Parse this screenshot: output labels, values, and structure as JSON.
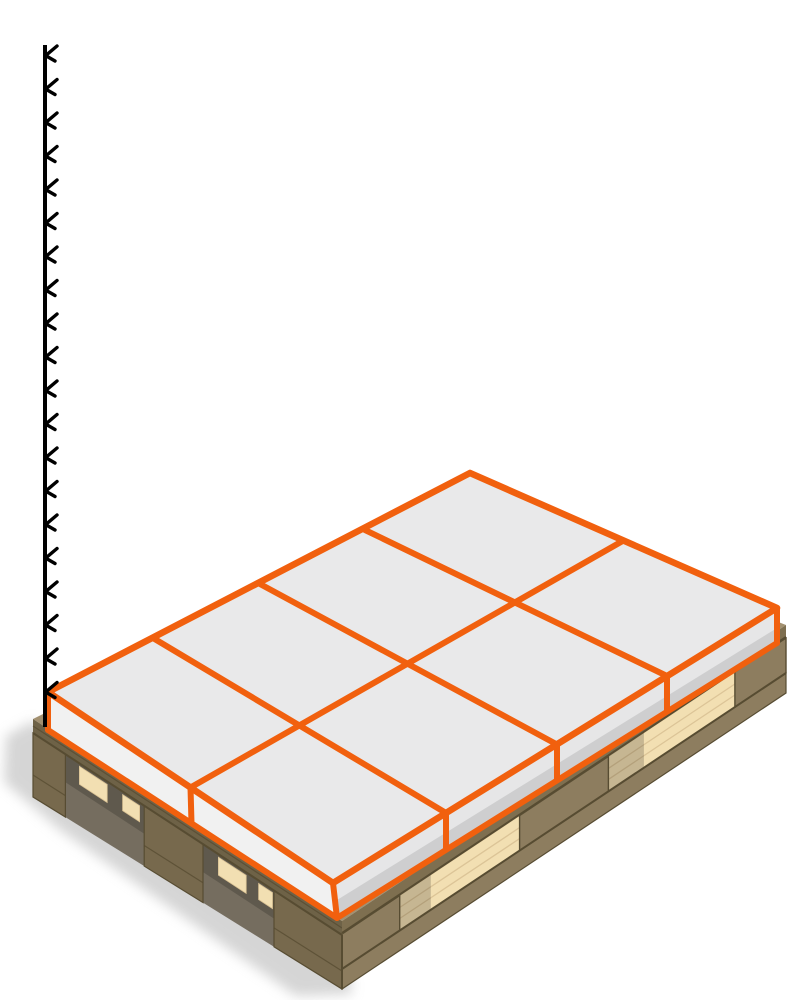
{
  "scene": {
    "title": "3D pallet load preview",
    "description": "Isometric render of a wooden block pallet carrying one layer of flat boxes outlined in orange, with a vertical height reference line on the left",
    "background": "#ffffff"
  },
  "viewport": {
    "width": 810,
    "height": 1000
  },
  "load": {
    "layers_shown": 1,
    "boxes_per_layer": 8,
    "arrangement_columns": 4,
    "arrangement_rows": 2,
    "box_shape": "flat slab"
  },
  "pallet": {
    "style": "wooden block pallet",
    "visible_blocks_left_face": 3,
    "visible_blocks_right_face": 3,
    "fork_openings_right_face": 2
  },
  "height_axis": {
    "icon": "height-ruler-ticks",
    "tick_glyph": "<",
    "tick_count": 20,
    "tick_start_y": 55,
    "tick_step": 33.5,
    "line_x": 45,
    "line_top_y": 45,
    "line_bottom_y": 727
  },
  "colors": {
    "background": "#ffffff",
    "orange": "#F1600E",
    "box_top": "#E9E9EA",
    "box_side_left": "#F1F1F1",
    "box_side_right": "#E6E6E7",
    "deck_top": "#A29070",
    "wood_band_left": "#6E6247",
    "wood_band_right": "#7E6F50",
    "wood_dark_face": "#77694D",
    "wood_mid_face": "#8D7D5F",
    "wood_board": "#8D7D5F",
    "wood_light": "#F2DFB2",
    "wood_grain": "#D9C193",
    "wood_outline": "#574C32",
    "bay_dark": "#756D5F",
    "axis": "#000000",
    "shadow": "#B3B3B3"
  }
}
